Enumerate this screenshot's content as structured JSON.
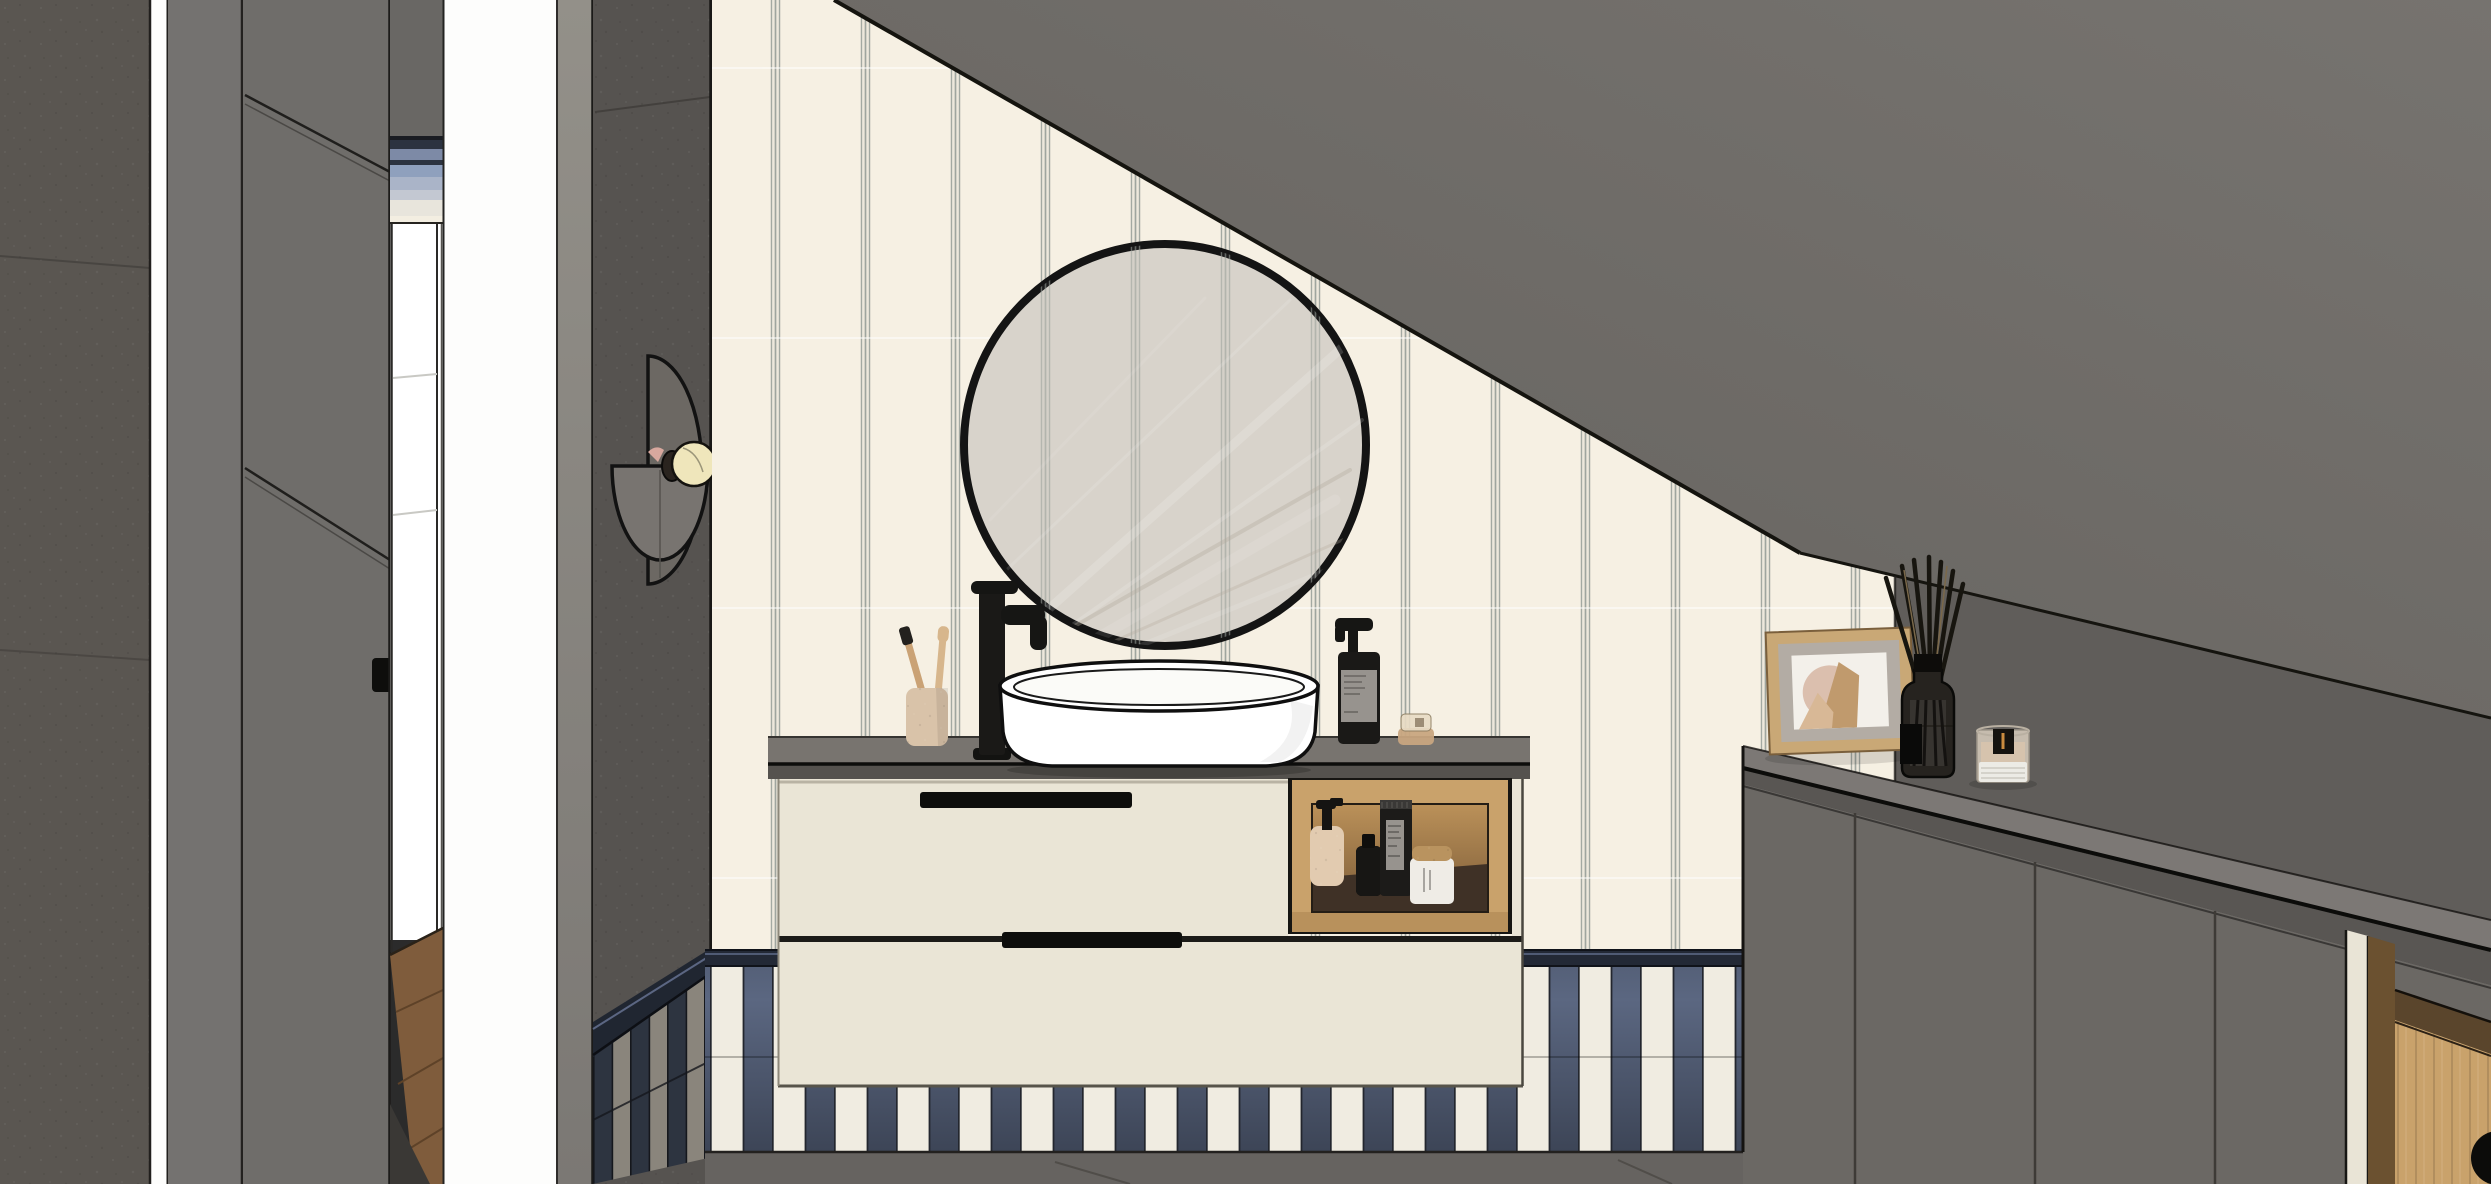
{
  "meta": {
    "description": "SketchUp-style 3D interior rendering of an attic bathroom: floating cream vanity with vessel sink, round black-rim mirror on pinstripe wallpaper, navy-and-white striped tile wainscot, sloped dark ceiling, gray sideboard with decor, hallway with white door on the left",
    "visible_text": "none — bottle and candle labels are illegible smudges"
  },
  "palette": {
    "wall_left": "#5a5651",
    "white_gap": "#fdfdfc",
    "panel_gray": "#747270",
    "door_gray": "#6f6d6a",
    "hall_wall": "#696764",
    "towel_line": "#1a1c22",
    "towel_dark": "#2c3340",
    "towel_blue": "#7d8aa6",
    "towel_steel": "#8fa0bd",
    "towel_pale": "#aab4c8",
    "towel_white": "#c3c8d2",
    "shelf_cream": "#f3eee1",
    "hall_door": "#ffffff",
    "wood_floor": "#7f5c3c",
    "side_strip": "#8c8985",
    "sconce_wall": "#565350",
    "sconce_plate": "#6c6863",
    "sconce_plate2": "#787470",
    "bulb": "#efe6bb",
    "wallpaper": "#f6f0e3",
    "pinstripe": "#9aa19b",
    "slope": "#6e6b67",
    "knee_wall": "#605d5a",
    "mirror_glass": "#d8d3cb",
    "mirror_rim": "#141414",
    "counter": "#78746f",
    "counter_edge": "#55524e",
    "vanity": "#eae5d6",
    "handle_dark": "#0e0e0c",
    "oak": "#c9a26b",
    "oak_dark": "#6b5130",
    "niche_floor": "#3f3126",
    "tile_white": "#f0ece1",
    "tile_navy": "#39414f",
    "tile_tan": "#8a857c",
    "cap_navy": "#232936",
    "floor": "#666360",
    "beige": "#e2cbb0",
    "black": "#1a1917",
    "label_gray": "#97938e",
    "candle_white": "#efece6",
    "cork": "#b9935f",
    "cab_front": "#6b6864",
    "cab_top": "#7c7875",
    "cab_edge": "#595653",
    "cream_trim": "#e9e4d6",
    "frame_oak": "#c9a876",
    "frame_mat": "#b3aca4",
    "art_bg": "#f3f0ea",
    "art_blush": "#d9bcab",
    "art_tan": "#c09a6d",
    "art_tan2": "#d8b896",
    "wax": "#d6c3ad",
    "glass": "#d8cdbd",
    "flame": "#c98b3f",
    "toothbrush_wood": "#caa275",
    "cup_beige": "#d9c3a9"
  },
  "objects": [
    "textured concrete wall (far left)",
    "bright light gap",
    "gray wardrobe panel and door with diagonal seams and black recessed handle",
    "hallway glimpse: folded towels on shelf, white door, oak floor",
    "half-moon wall sconce with brass/cream bulb",
    "cream pinstripe wallpaper",
    "dark sloped attic ceiling and knee wall",
    "round mirror with thin black rim reflecting light streaks",
    "tall black vessel faucet",
    "white oval vessel sink on gray countertop",
    "speckled cup with two wooden toothbrushes",
    "black pump soap bottle with gray label",
    "small translucent cosmetic jar",
    "floating cream vanity: two drawer fronts with black recessed handles",
    "oak open niche with lotion pump bottle, black dropper bottle, black tube, cork-lid candle jar",
    "navy and white striped tile wainscot (two tile rows)",
    "gray tile floor",
    "gray attic sideboard with long countertop",
    "leaning oak picture frame with abstract beige art",
    "black reed diffuser with tall reeds",
    "lit candle in a glass holder",
    "oak drawer with round cutout handle (bottom right)"
  ]
}
